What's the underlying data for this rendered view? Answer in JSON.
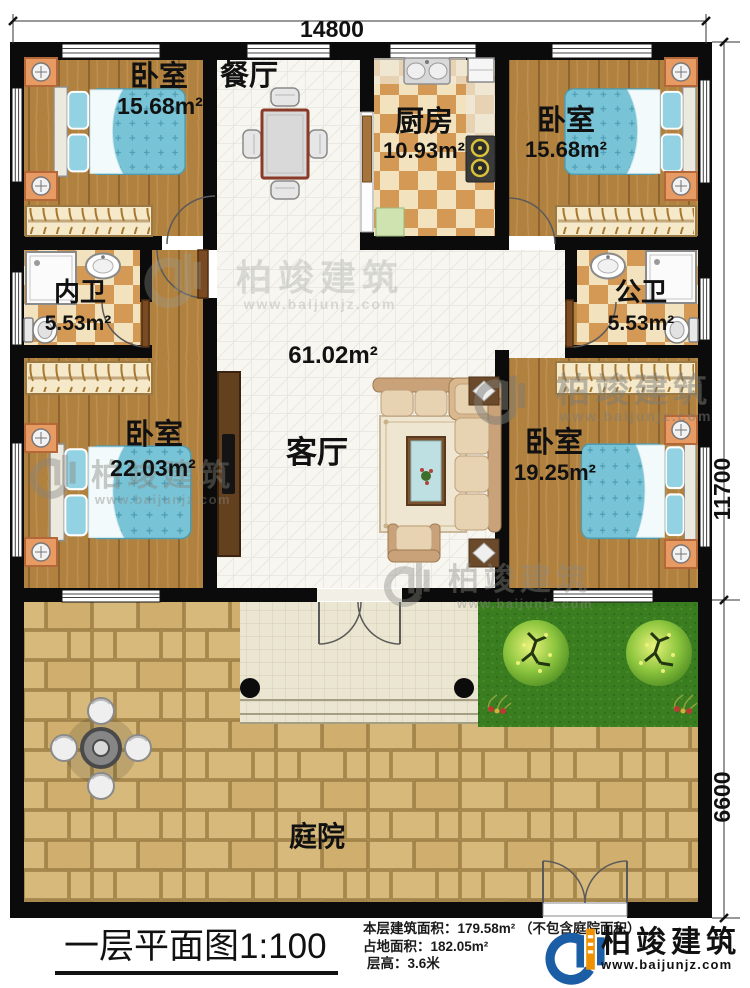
{
  "plan": {
    "dimensions": {
      "width": "14800",
      "depth_house": "11700",
      "depth_yard": "6600"
    },
    "rooms": {
      "bedroom_tl": {
        "name": "卧室",
        "area": "15.68m²"
      },
      "dining": {
        "name": "餐厅"
      },
      "kitchen": {
        "name": "厨房",
        "area": "10.93m²"
      },
      "bedroom_tr": {
        "name": "卧室",
        "area": "15.68m²"
      },
      "bath_inner": {
        "name": "内卫",
        "area": "5.53m²"
      },
      "bath_public": {
        "name": "公卫",
        "area": "5.53m²"
      },
      "hall": {
        "name": "客厅",
        "area": "61.02m²"
      },
      "bedroom_bl": {
        "name": "卧室",
        "area": "22.03m²"
      },
      "bedroom_br": {
        "name": "卧室",
        "area": "19.25m²"
      },
      "courtyard": {
        "name": "庭院"
      }
    }
  },
  "footer": {
    "title": "一层平面图1:100",
    "stats": [
      "本层建筑面积：179.58m²  （不包含庭院面积）",
      "占地面积：182.05m²",
      "层高：3.6米"
    ],
    "brand": {
      "name": "柏竣建筑",
      "site": "www.baijunjz.com"
    }
  },
  "watermark": {
    "name": "柏竣建筑",
    "site": "www.baijunjz.com"
  },
  "colors": {
    "wall": "#0b0b0b",
    "wood": "#b1813f",
    "accent_blue": "#1b5ea6",
    "accent_orange": "#f09200"
  }
}
